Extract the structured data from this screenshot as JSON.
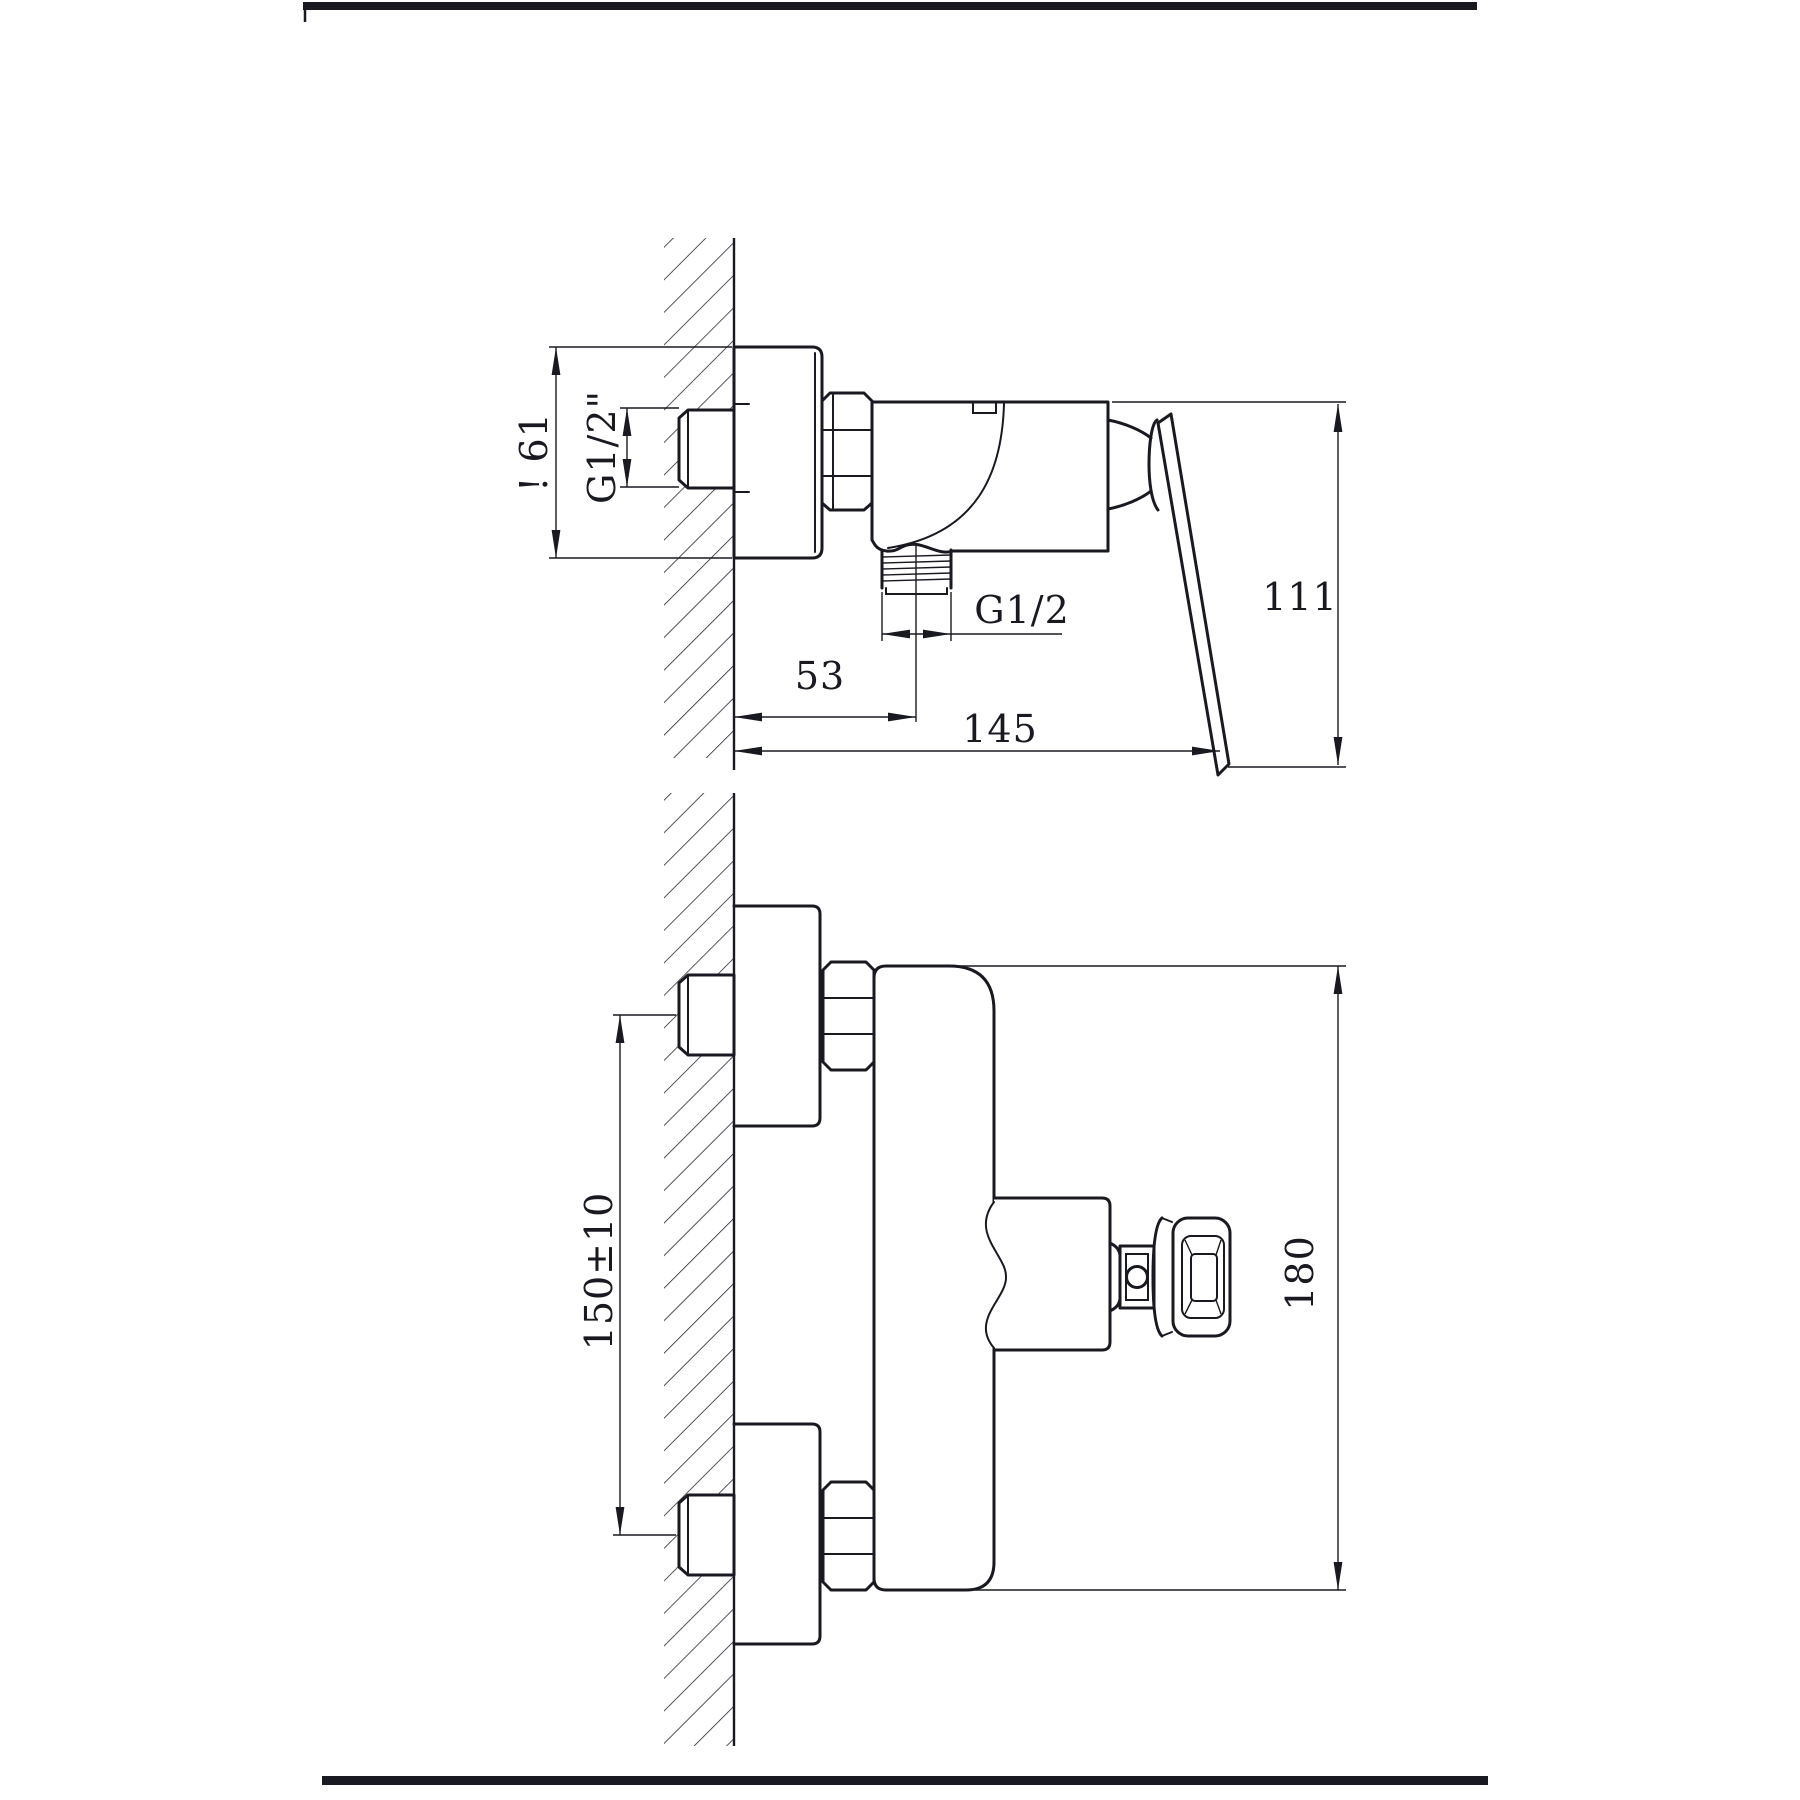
{
  "page": {
    "background": "#ffffff",
    "ink": "#191922"
  },
  "side_view": {
    "escutcheon_diameter": "! 61",
    "inlet_thread": "G1/2\"",
    "outlet_thread": "G1/2",
    "wall_to_outlet_center": "53",
    "overall_depth": "145",
    "overall_height": "111"
  },
  "front_view": {
    "inlet_spacing": "150±10",
    "overall_height": "180"
  }
}
